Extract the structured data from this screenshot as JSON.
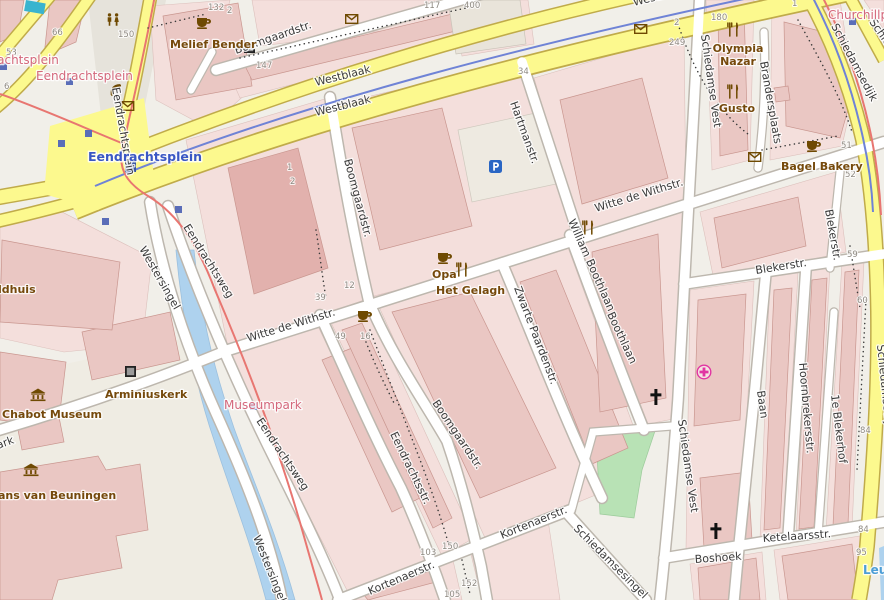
{
  "map": {
    "title": "OpenStreetMap-style city map, Witte de Withstraat area, Rotterdam",
    "colors": {
      "background": "#f1efe9",
      "major_road": "#fcf98e",
      "minor_road": "#ffffff",
      "building": "#eac7c3",
      "block": "#f4dfdc",
      "water": "#aed2ee",
      "green": "#b8e2b5",
      "tram_line": "#e87671",
      "cycleway": "#6f83d6",
      "poi_text": "#75490b",
      "place_text": "#d4687c",
      "station_text": "#3a57c4",
      "water_text": "#4d9ed6"
    },
    "street_labels": [
      {
        "text": "Westblaak",
        "x": 316,
        "y": 86,
        "r": -14,
        "s": 12.5
      },
      {
        "text": "Westblaak",
        "x": 316,
        "y": 116,
        "r": -14,
        "s": 12.5
      },
      {
        "text": "Westblaak",
        "x": 634,
        "y": 6,
        "r": -14,
        "s": 12.5
      },
      {
        "text": "Boomgaardstr.",
        "x": 236,
        "y": 54,
        "r": -19
      },
      {
        "text": "Eendrachtsplein",
        "x": 112,
        "y": 88,
        "r": 80
      },
      {
        "text": "Westersingel",
        "x": 139,
        "y": 249,
        "r": 60
      },
      {
        "text": "Westersingel",
        "x": 253,
        "y": 537,
        "r": 68
      },
      {
        "text": "Eendrachtsweg",
        "x": 183,
        "y": 227,
        "r": 58
      },
      {
        "text": "Eendrachtsweg",
        "x": 256,
        "y": 421,
        "r": 56
      },
      {
        "text": "ark",
        "x": -2,
        "y": 449,
        "r": -20
      },
      {
        "text": "Witte de Withstr.",
        "x": 248,
        "y": 342,
        "r": -17,
        "s": 12
      },
      {
        "text": "Witte de Withstr.",
        "x": 596,
        "y": 212,
        "r": -17,
        "s": 12
      },
      {
        "text": "Boomgaardstr.",
        "x": 344,
        "y": 160,
        "r": 75
      },
      {
        "text": "Boomgaardstr.",
        "x": 432,
        "y": 403,
        "r": 56
      },
      {
        "text": "Eendrachtsstr.",
        "x": 390,
        "y": 434,
        "r": 64
      },
      {
        "text": "Hartmanstr.",
        "x": 510,
        "y": 103,
        "r": 70
      },
      {
        "text": "Zwarte Paardenstr.",
        "x": 514,
        "y": 288,
        "r": 69
      },
      {
        "text": "William Boothlaan",
        "x": 568,
        "y": 221,
        "r": 66
      },
      {
        "text": "Boothlaan",
        "x": 607,
        "y": 314,
        "r": 65
      },
      {
        "text": "Kortenaerstr.",
        "x": 370,
        "y": 595,
        "r": -23,
        "s": 12
      },
      {
        "text": "Kortenaerstr.",
        "x": 502,
        "y": 539,
        "r": -22,
        "s": 12
      },
      {
        "text": "Schiedamsesingel",
        "x": 573,
        "y": 529,
        "r": 45
      },
      {
        "text": "Schiedamse Vest",
        "x": 701,
        "y": 35,
        "r": 82
      },
      {
        "text": "Schiedamse Vest",
        "x": 678,
        "y": 420,
        "r": 82
      },
      {
        "text": "Brandersplaats",
        "x": 760,
        "y": 62,
        "r": 80
      },
      {
        "text": "Blekerstr.",
        "x": 756,
        "y": 274,
        "r": -9,
        "s": 12
      },
      {
        "text": "Blekerstr.",
        "x": 825,
        "y": 210,
        "r": 80
      },
      {
        "text": "Baan",
        "x": 757,
        "y": 391,
        "r": 82
      },
      {
        "text": "Hoornbrekersstr.",
        "x": 799,
        "y": 363,
        "r": 85
      },
      {
        "text": "1e Blekerhof",
        "x": 831,
        "y": 395,
        "r": 83
      },
      {
        "text": "Ketelaarsstr.",
        "x": 763,
        "y": 542,
        "r": -4,
        "s": 12
      },
      {
        "text": "Boshoek",
        "x": 695,
        "y": 563,
        "r": -4,
        "s": 12
      },
      {
        "text": "Schiedamsedijk",
        "x": 831,
        "y": 26,
        "r": 62
      },
      {
        "text": "Schiedamsedijk",
        "x": 877,
        "y": 345,
        "r": 84
      },
      {
        "text": "Schiedamsedijk",
        "x": 869,
        "y": 22,
        "r": 55
      },
      {
        "text": "Hartmanstr.",
        "x": 529,
        "y": 141,
        "r": 72,
        "s": 0
      }
    ],
    "place_labels": [
      {
        "text": "Eendrachtsplein",
        "x": -38,
        "y": 64
      },
      {
        "text": "Eendrachtsplein",
        "x": 36,
        "y": 80
      },
      {
        "text": "Museumpark",
        "x": 224,
        "y": 409
      },
      {
        "text": "Churchillplein",
        "x": 828,
        "y": 19
      }
    ],
    "station_label": {
      "text": "Eendrachtsplein",
      "x": 88,
      "y": 161
    },
    "water_label": {
      "text": "Leu",
      "x": 863,
      "y": 574
    },
    "poi_labels": [
      {
        "text": "Melief Bender",
        "x": 170,
        "y": 48
      },
      {
        "text": "Opa",
        "x": 432,
        "y": 278
      },
      {
        "text": "Het Gelagh",
        "x": 436,
        "y": 294
      },
      {
        "text": "Olympia",
        "x": 738,
        "y": 52,
        "a": "middle"
      },
      {
        "text": "Nazar",
        "x": 738,
        "y": 65,
        "a": "middle"
      },
      {
        "text": "Gusto",
        "x": 737,
        "y": 112,
        "a": "middle"
      },
      {
        "text": "Bagel Bakery",
        "x": 781,
        "y": 170
      },
      {
        "text": "Chabot Museum",
        "x": 2,
        "y": 418
      },
      {
        "text": "ans van Beuningen",
        "x": -2,
        "y": 499
      },
      {
        "text": "ldhuis",
        "x": -2,
        "y": 293
      },
      {
        "text": "Arminiuskerk",
        "x": 105,
        "y": 398,
        "c": "#3a3a3a",
        "w": "normal",
        "s": 12
      }
    ],
    "house_numbers": [
      {
        "n": "66",
        "x": 52,
        "y": 35
      },
      {
        "n": "53",
        "x": 6,
        "y": 55
      },
      {
        "n": "6",
        "x": 4,
        "y": 89
      },
      {
        "n": "150",
        "x": 118,
        "y": 37
      },
      {
        "n": "132",
        "x": 208,
        "y": 10
      },
      {
        "n": "2",
        "x": 227,
        "y": 13
      },
      {
        "n": "117",
        "x": 424,
        "y": 8
      },
      {
        "n": "147",
        "x": 256,
        "y": 68
      },
      {
        "n": "400",
        "x": 464,
        "y": 8
      },
      {
        "n": "34",
        "x": 518,
        "y": 74
      },
      {
        "n": "2",
        "x": 674,
        "y": 25
      },
      {
        "n": "180",
        "x": 711,
        "y": 20
      },
      {
        "n": "249",
        "x": 669,
        "y": 45
      },
      {
        "n": "1",
        "x": 792,
        "y": 6
      },
      {
        "n": "51",
        "x": 841,
        "y": 148
      },
      {
        "n": "52",
        "x": 845,
        "y": 177
      },
      {
        "n": "59",
        "x": 847,
        "y": 257
      },
      {
        "n": "60",
        "x": 857,
        "y": 303
      },
      {
        "n": "39",
        "x": 315,
        "y": 300
      },
      {
        "n": "12",
        "x": 344,
        "y": 288
      },
      {
        "n": "49",
        "x": 335,
        "y": 339
      },
      {
        "n": "16",
        "x": 360,
        "y": 339
      },
      {
        "n": "103",
        "x": 420,
        "y": 555
      },
      {
        "n": "150",
        "x": 442,
        "y": 549
      },
      {
        "n": "152",
        "x": 461,
        "y": 586
      },
      {
        "n": "105",
        "x": 444,
        "y": 597
      },
      {
        "n": "84",
        "x": 860,
        "y": 433
      },
      {
        "n": "84",
        "x": 858,
        "y": 532
      },
      {
        "n": "95",
        "x": 856,
        "y": 555
      },
      {
        "n": "1",
        "x": 287,
        "y": 170
      },
      {
        "n": "2",
        "x": 290,
        "y": 184
      }
    ],
    "icons": [
      {
        "t": "cafe",
        "x": 196,
        "y": 16
      },
      {
        "t": "cafe",
        "x": 437,
        "y": 251
      },
      {
        "t": "cafe",
        "x": 357,
        "y": 309
      },
      {
        "t": "cafe",
        "x": 806,
        "y": 139
      },
      {
        "t": "restaurant",
        "x": 727,
        "y": 22
      },
      {
        "t": "restaurant",
        "x": 727,
        "y": 84
      },
      {
        "t": "restaurant",
        "x": 456,
        "y": 262
      },
      {
        "t": "restaurant",
        "x": 582,
        "y": 220
      },
      {
        "t": "toilets",
        "x": 106,
        "y": 13
      },
      {
        "t": "phone",
        "x": 109,
        "y": 84
      },
      {
        "t": "mail",
        "x": 121,
        "y": 101
      },
      {
        "t": "mail",
        "x": 345,
        "y": 14
      },
      {
        "t": "mail",
        "x": 634,
        "y": 24
      },
      {
        "t": "mail",
        "x": 748,
        "y": 152
      },
      {
        "t": "parking",
        "x": 489,
        "y": 160
      },
      {
        "t": "museum",
        "x": 30,
        "y": 388
      },
      {
        "t": "museum",
        "x": 23,
        "y": 463
      },
      {
        "t": "landmark",
        "x": 244,
        "y": 42
      },
      {
        "t": "landmark",
        "x": 125,
        "y": 366
      },
      {
        "t": "church",
        "x": 649,
        "y": 389
      },
      {
        "t": "church",
        "x": 709,
        "y": 523
      },
      {
        "t": "pharmacy",
        "x": 696,
        "y": 364
      },
      {
        "t": "metro",
        "x": 0,
        "y": 63
      },
      {
        "t": "metro",
        "x": 66,
        "y": 78
      },
      {
        "t": "metro",
        "x": 85,
        "y": 130
      },
      {
        "t": "metro",
        "x": 58,
        "y": 140
      },
      {
        "t": "metro",
        "x": 102,
        "y": 218
      },
      {
        "t": "metro",
        "x": 175,
        "y": 206
      },
      {
        "t": "metro",
        "x": 250,
        "y": 403
      },
      {
        "t": "metro",
        "x": 849,
        "y": 18
      },
      {
        "t": "metro-large",
        "x": 125,
        "y": 161
      },
      {
        "t": "pool",
        "x": 26,
        "y": 0
      }
    ]
  }
}
